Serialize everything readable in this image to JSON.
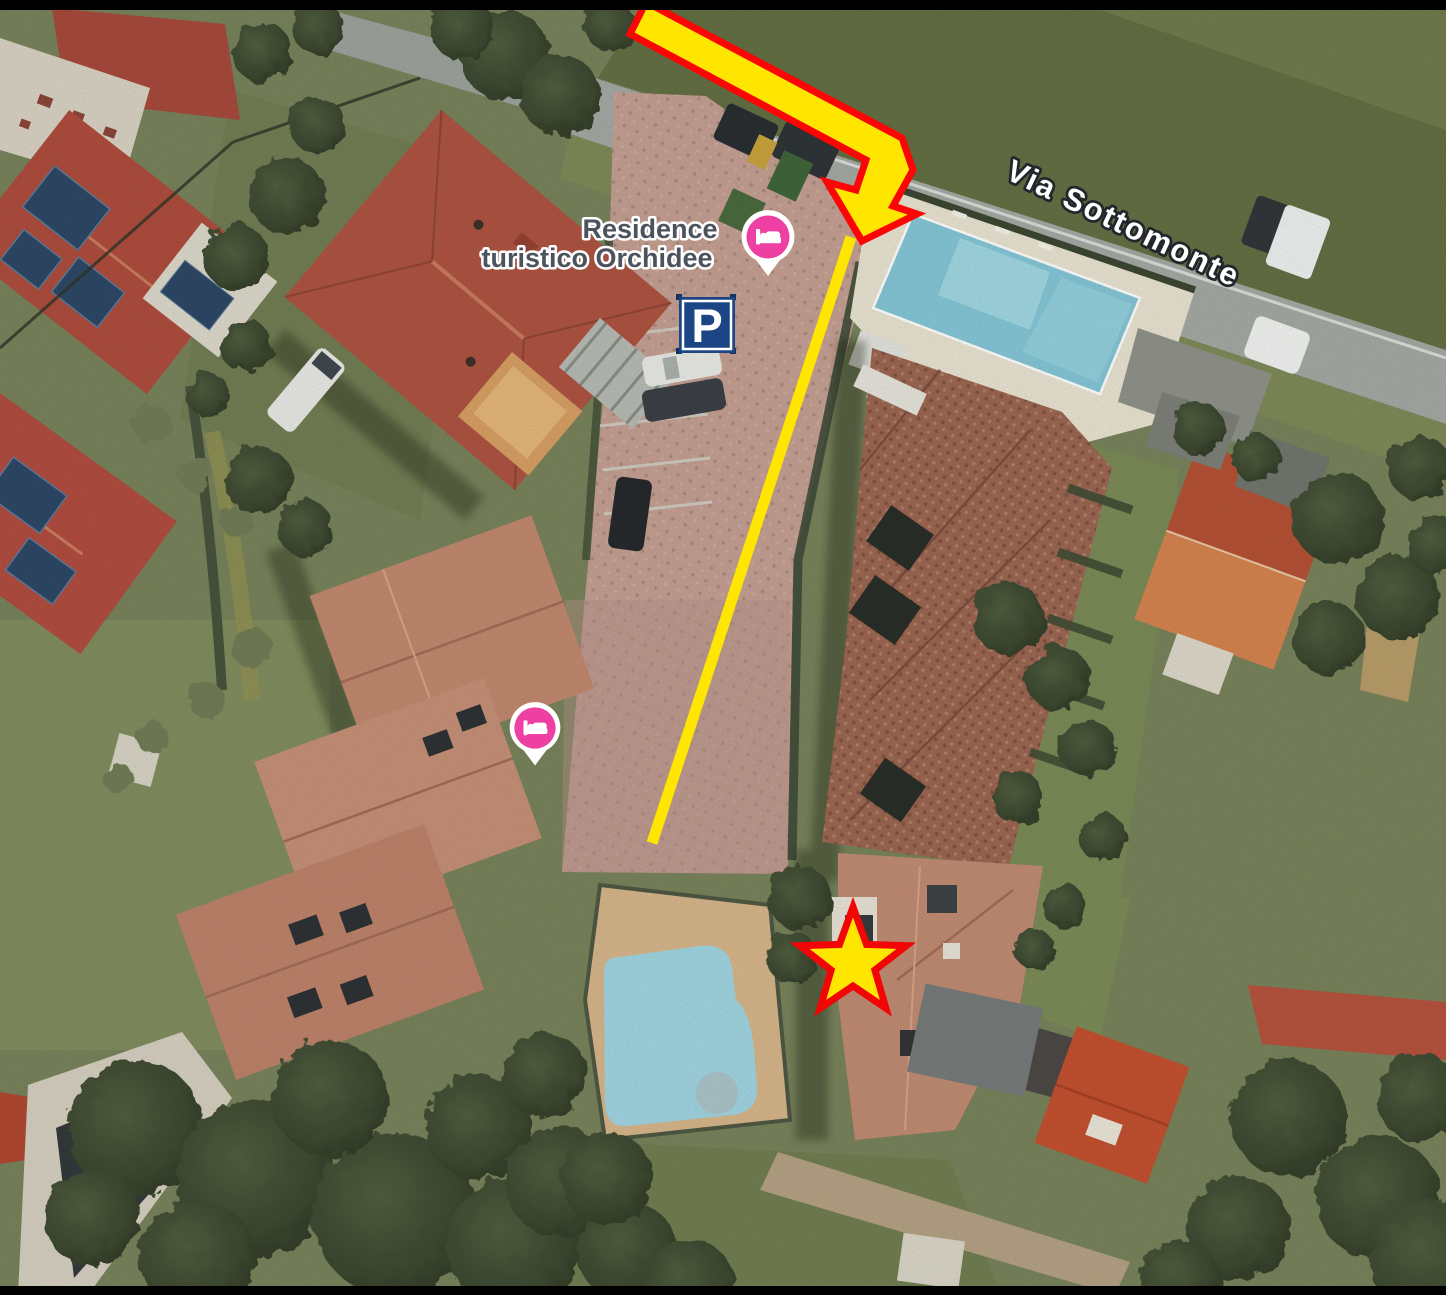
{
  "map": {
    "type": "satellite-imagery-with-annotations",
    "labels": {
      "place_line1": "Residence",
      "place_line2": "turistico Orchidee",
      "street": "Via Sottomonte",
      "parking_letter": "P"
    },
    "markers": {
      "lodging_pin_icon": "bed-icon",
      "parking_sign_icon": "parking-icon",
      "pin_color": "#ee3fa3",
      "pin_border_color": "#ffffff",
      "parking_sign_color": "#1c4585",
      "place_label_color": "#4d535d",
      "street_label_color": "#ffffff"
    },
    "annotations": {
      "route_color": "#ffe600",
      "route_outline_color": "#fb0505",
      "star_fill": "#ffe600",
      "star_outline": "#f20505",
      "arrow_name": "entrance-arrow",
      "line_name": "route-line",
      "star_name": "destination-star"
    },
    "scene": {
      "pool_water_color": "#83c6d8",
      "roof_red": "#ad4a3c",
      "roof_salmon": "#c1876e",
      "grass": "#76815a",
      "road": "#a3a8a4"
    }
  }
}
